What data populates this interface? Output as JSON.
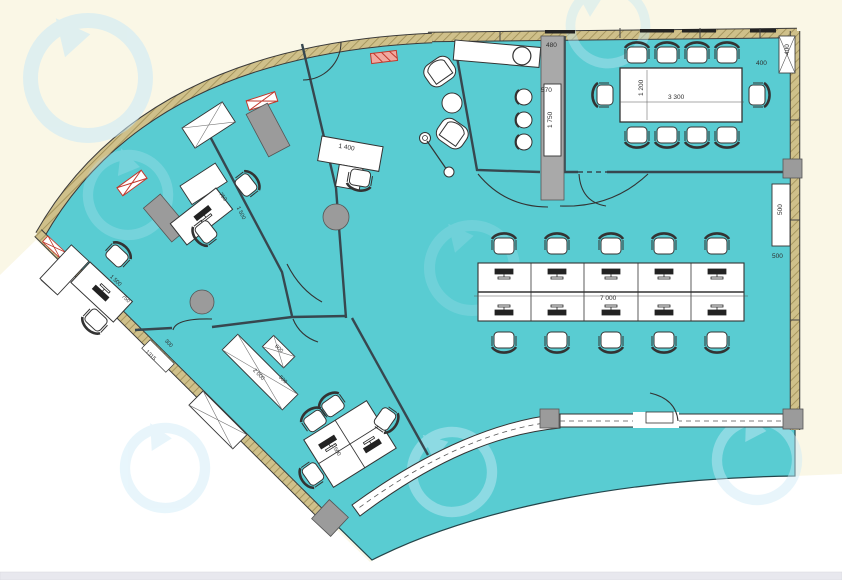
{
  "plan": {
    "conference": {
      "table_width": "1 200",
      "table_length": "3 300",
      "corner_offset": "400",
      "corner_box": "400"
    },
    "kitchen": {
      "counter_depth": "480",
      "bar_width": "570",
      "bar_length": "1 750"
    },
    "right_wall": {
      "cabinet": "500",
      "offset": "500"
    },
    "open_office": {
      "desk_run": "7 000"
    },
    "reception": {
      "desk": "1 400"
    },
    "office_a": {
      "desk_width": "750",
      "desk_length": "1 500"
    },
    "office_b": {
      "desk_length": "1 500",
      "desk_width": "750"
    },
    "team_room": {
      "desk": "1 500"
    },
    "corridor": {
      "entrance": "1315",
      "offset": "300",
      "wardrobe_small": "600",
      "wardrobe_mid": "500",
      "wardrobe_long": "2 000"
    },
    "colors": {
      "floor": "#59ccd2",
      "wall": "#cfc08a",
      "pillar": "#9b9b9b",
      "marker_red": "#cc3b2e",
      "watermark": "#c9e9f7",
      "background": "#faf7e6"
    }
  }
}
